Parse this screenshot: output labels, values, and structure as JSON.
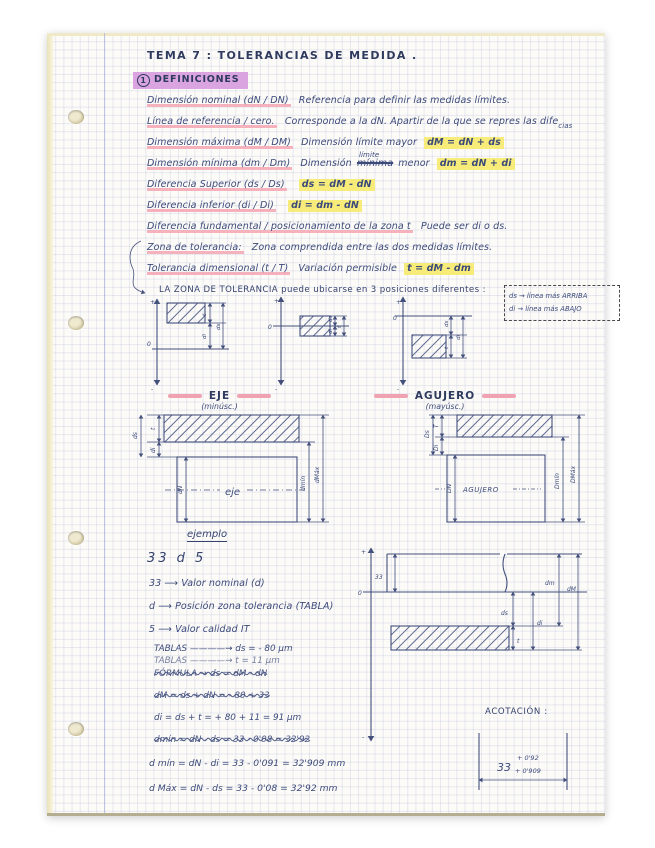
{
  "page": {
    "title": "TEMA 7 :   TOLERANCIAS  DE  MEDIDA .",
    "section_number": "1",
    "section_title": "DEFINICIONES"
  },
  "definitions": [
    {
      "term": "Dimensión nominal (dN / DN)",
      "text": "Referencia para definir las medidas límites."
    },
    {
      "term": "Línea de referencia / cero.",
      "text": "Corresponde a la dN. Apartir de la que se repres las dife",
      "suffix": "cias"
    },
    {
      "term": "Dimensión máxima (dM / DM)",
      "text": "Dimensión límite mayor",
      "formula": "dM = dN + ds"
    },
    {
      "term": "Dimensión mínima (dm / Dm)",
      "text_pre": "Dimensión",
      "struck": "mínima",
      "above": "límite",
      "text_post": "menor",
      "formula": "dm = dN + di"
    },
    {
      "term": "Diferencia Superior (ds / Ds)",
      "formula": "ds = dM - dN"
    },
    {
      "term": "Diferencia inferior (di / Di)",
      "formula": "di = dm - dN"
    },
    {
      "term": "Diferencia fundamental / posicionamiento de la zona t",
      "text": "Puede ser di o ds."
    },
    {
      "term": "Zona de tolerancia:",
      "text": "Zona comprendida entre las dos medidas límites."
    },
    {
      "term": "Tolerancia dimensional (t / T)",
      "text": "Variación permisible",
      "formula": "t = dM - dm"
    }
  ],
  "positions_note": "LA ZONA DE TOLERANCIA  puede ubicarse  en  3  posiciones  diferentes :",
  "axis": {
    "plus": "+",
    "zero": "0",
    "minus": "-"
  },
  "dims": {
    "t": "t",
    "di": "di",
    "ds": "ds"
  },
  "note_box": {
    "line1": "ds → línea más ARRIBA",
    "line2": "di → línea más ABAJO"
  },
  "eje": {
    "title": "EJE",
    "subtitle": "(minúsc.)",
    "body_label": "eje",
    "labels": {
      "ds": "ds",
      "di": "di",
      "t": "t",
      "dN": "dN",
      "dmin": "dmín",
      "dmax": "dMáx"
    }
  },
  "agujero": {
    "title": "AGUJERO",
    "subtitle": "(mayúsc.)",
    "body_label": "AGUJERO",
    "labels": {
      "Ds": "Ds",
      "Di": "Di",
      "T": "T",
      "DN": "DN",
      "Dmin": "Dmín",
      "Dmax": "DMáx"
    }
  },
  "example": {
    "heading": "ejemplo",
    "code": "33 d 5",
    "bullets": [
      "33 ⟶  Valor nominal (d)",
      "d ⟶  Posición zona tolerancia (TABLA)",
      "5 ⟶  Valor calidad  IT"
    ],
    "calc_lines": [
      {
        "text": "TABLAS ————→   ds = - 80 μm"
      },
      {
        "text": "TABLAS ————→   t  =  11 μm"
      },
      {
        "text": "FÓRMULA  →  ds = dM - dN"
      },
      {
        "text": "dM = ds + dN = - 80 + 33"
      },
      {
        "text": "di = ds + t   =   + 80 + 11 = 91 μm"
      },
      {
        "text": "dmín = dN - ds = 33 - 0'08 = 32'92"
      },
      {
        "text": "d mín =   dN - di  =  33  - 0'091 = 32'909 mm"
      },
      {
        "text": "d Máx =   dN - ds =  33  -  0'08  =  32'92 mm"
      }
    ],
    "diagram": {
      "nominal": "33",
      "ds": "ds",
      "t": "t",
      "di": "di",
      "dm": "dm",
      "dM": "dM"
    },
    "acotacion_label": "ACOTACIÓN :",
    "acotacion": {
      "base": "33",
      "sup": "+ 0'92",
      "sub": "+ 0'909"
    }
  }
}
